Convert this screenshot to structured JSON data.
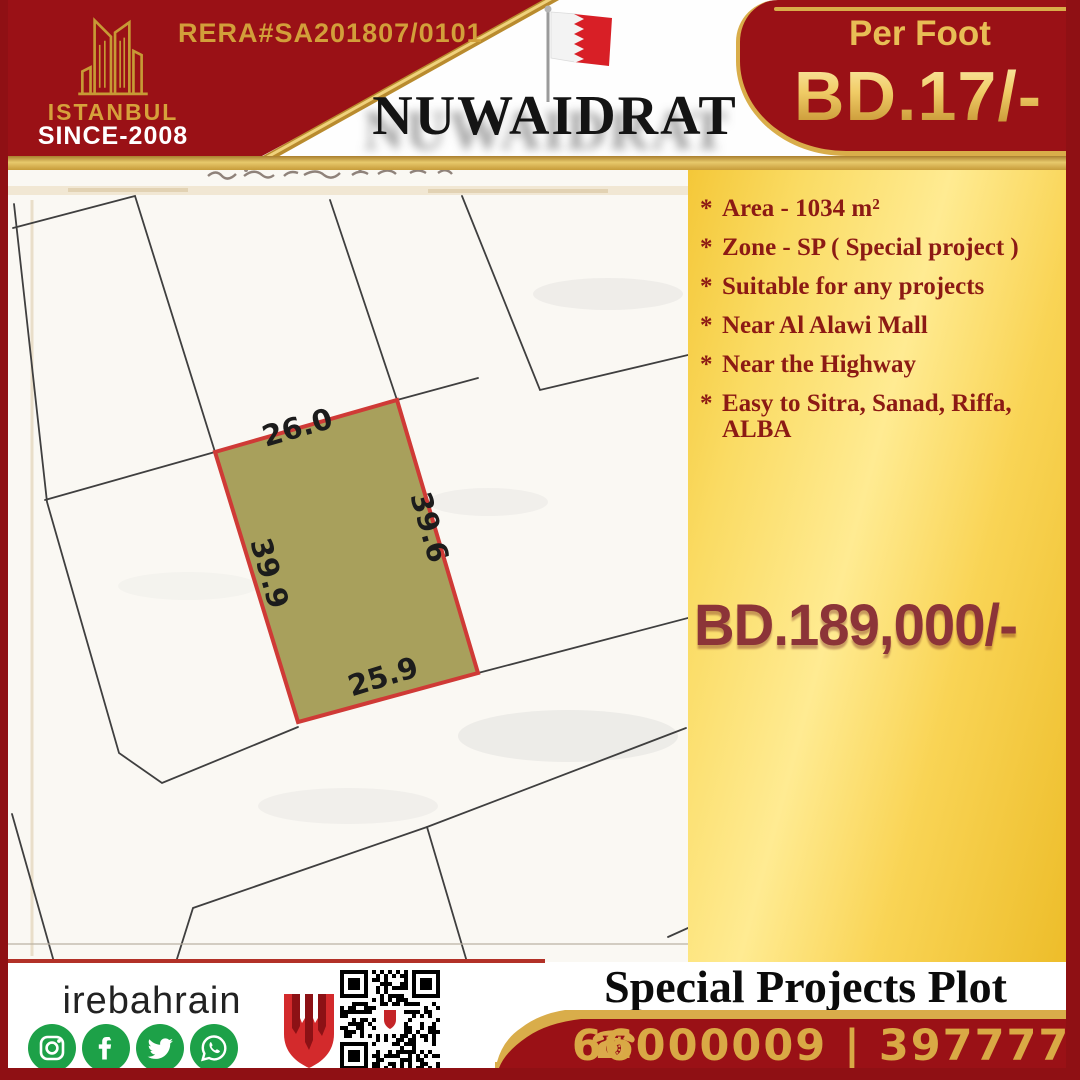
{
  "colors": {
    "maroon_red": "#9a1116",
    "frame_red": "#8f1014",
    "gold_trim": "#d9ad4a",
    "gold_text": "#d6a13b",
    "panel_gold": "#f9d455",
    "plot_olive": "#a8a05c",
    "plot_border_red": "#cf3a36",
    "price_maroon": "#8c3438",
    "social_green": "#1da148"
  },
  "brand": {
    "logo_icon": "istanbul-towers-icon",
    "name": "ISTANBUL",
    "since": "SINCE-2008",
    "rera": "RERA#SA201807/0101"
  },
  "header": {
    "location_title": "NUWAIDRAT",
    "flag_icon": "bahrain-flag-icon",
    "per_foot_label": "Per Foot",
    "per_foot_price": "BD.17/-"
  },
  "features": {
    "bullet": "*",
    "items": [
      "Area - 1034 m²",
      "Zone - SP ( Special project )",
      "Suitable for any projects",
      "Near Al Alawi Mall",
      "Near the Highway",
      "Easy to Sitra, Sanad, Riffa, ALBA"
    ]
  },
  "pricing": {
    "total": "BD.189,000/-"
  },
  "map": {
    "plot_dimensions": {
      "top": "26.0",
      "right": "39.6",
      "left": "39.9",
      "bottom": "25.9"
    }
  },
  "footer": {
    "handle": "irebahrain",
    "social_icons": [
      "instagram-icon",
      "facebook-icon",
      "twitter-icon",
      "whatsapp-icon"
    ],
    "title": "Special Projects Plot",
    "phone_icon": "☎",
    "phones": "66000009 | 39777724"
  }
}
